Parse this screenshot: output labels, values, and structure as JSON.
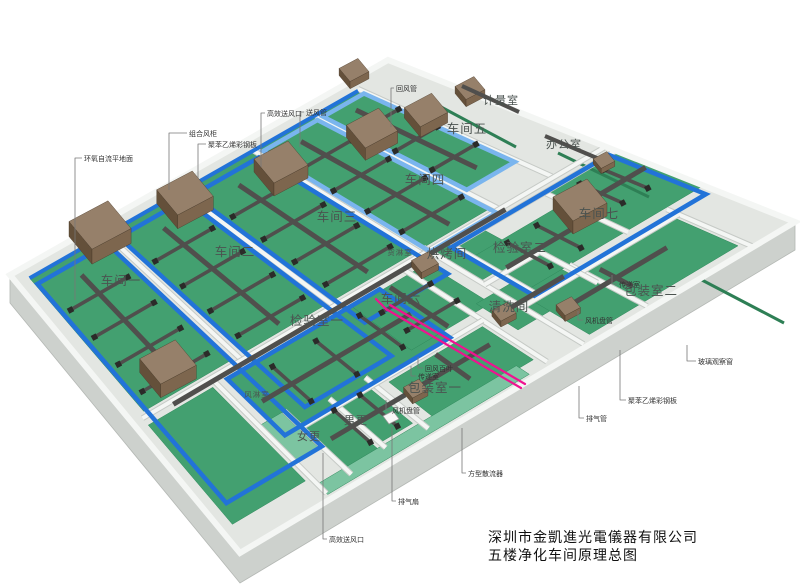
{
  "title": {
    "company": "深圳市金凱進光電儀器有限公司",
    "drawing": "五楼净化车间原理总图"
  },
  "room_labels": [
    {
      "id": "workshop-1",
      "label": "车间一",
      "x": 121,
      "y": 285,
      "fs": 12.5
    },
    {
      "id": "workshop-2",
      "label": "车间二",
      "x": 235,
      "y": 256,
      "fs": 12.5
    },
    {
      "id": "workshop-3",
      "label": "车间三",
      "x": 337,
      "y": 221,
      "fs": 12.5
    },
    {
      "id": "workshop-4",
      "label": "车间四",
      "x": 425,
      "y": 184,
      "fs": 12.5
    },
    {
      "id": "workshop-5",
      "label": "车间五",
      "x": 467,
      "y": 133,
      "fs": 12.5
    },
    {
      "id": "workshop-6",
      "label": "车间六",
      "x": 401,
      "y": 303,
      "fs": 12.5
    },
    {
      "id": "workshop-7",
      "label": "车间七",
      "x": 599,
      "y": 218,
      "fs": 12.5
    },
    {
      "id": "inspection-1",
      "label": "检验室一",
      "x": 317,
      "y": 325,
      "fs": 12.5
    },
    {
      "id": "inspection-2",
      "label": "检验室二",
      "x": 520,
      "y": 252,
      "fs": 12.5
    },
    {
      "id": "cleaning-room",
      "label": "清洗间",
      "x": 509,
      "y": 311,
      "fs": 12.5
    },
    {
      "id": "baking-room",
      "label": "烘烤间",
      "x": 447,
      "y": 258,
      "fs": 12.5
    },
    {
      "id": "packing-1",
      "label": "包装室一",
      "x": 435,
      "y": 392,
      "fs": 12.5
    },
    {
      "id": "packing-2",
      "label": "包装室二",
      "x": 651,
      "y": 295,
      "fs": 12.5
    },
    {
      "id": "men-changing",
      "label": "男更",
      "x": 356,
      "y": 424,
      "fs": 11
    },
    {
      "id": "women-changing",
      "label": "女更",
      "x": 309,
      "y": 440,
      "fs": 11
    },
    {
      "id": "air-shower",
      "label": "风淋室",
      "x": 257,
      "y": 397,
      "fs": 7.5
    },
    {
      "id": "cargo-shower",
      "label": "货淋室",
      "x": 400,
      "y": 255,
      "fs": 7.5
    },
    {
      "id": "office",
      "label": "办公室",
      "x": 564,
      "y": 148,
      "fs": 11
    },
    {
      "id": "metrology-room",
      "label": "计量室",
      "x": 501,
      "y": 104,
      "fs": 11
    }
  ],
  "callouts": [
    {
      "id": "epoxy-floor",
      "label": "环氧自流平地面",
      "tx": 84,
      "ty": 161,
      "line": [
        [
          82,
          158
        ],
        [
          75,
          158
        ],
        [
          75,
          300
        ]
      ]
    },
    {
      "id": "combined-ahu",
      "label": "组合风柜",
      "tx": 189,
      "ty": 136,
      "line": [
        [
          187,
          133
        ],
        [
          169,
          133
        ],
        [
          169,
          190
        ]
      ]
    },
    {
      "id": "steel-panel-1",
      "label": "聚苯乙烯彩钢板",
      "tx": 208,
      "ty": 147,
      "line": [
        [
          206,
          144
        ],
        [
          198,
          144
        ],
        [
          198,
          178
        ]
      ]
    },
    {
      "id": "hepa-outlet-1",
      "label": "高效送风口",
      "tx": 267,
      "ty": 116,
      "line": [
        [
          265,
          113
        ],
        [
          261,
          113
        ],
        [
          261,
          167
        ]
      ]
    },
    {
      "id": "supply-duct",
      "label": "送风管",
      "tx": 306,
      "ty": 115,
      "line": [
        [
          304,
          112
        ],
        [
          300,
          112
        ],
        [
          300,
          147
        ]
      ]
    },
    {
      "id": "return-duct",
      "label": "回风管",
      "tx": 396,
      "ty": 91,
      "line": [
        [
          394,
          88
        ],
        [
          391,
          88
        ],
        [
          391,
          127
        ]
      ]
    },
    {
      "id": "glass-window",
      "label": "玻璃观察窗",
      "tx": 698,
      "ty": 364,
      "line": [
        [
          696,
          361
        ],
        [
          687,
          361
        ],
        [
          687,
          345
        ]
      ]
    },
    {
      "id": "steel-panel-2",
      "label": "聚苯乙烯彩钢板",
      "tx": 628,
      "ty": 403,
      "line": [
        [
          626,
          400
        ],
        [
          620,
          400
        ],
        [
          620,
          350
        ]
      ]
    },
    {
      "id": "exhaust-pipe",
      "label": "排气管",
      "tx": 586,
      "ty": 421,
      "line": [
        [
          584,
          418
        ],
        [
          579,
          418
        ],
        [
          579,
          386
        ]
      ]
    },
    {
      "id": "square-diffuser",
      "label": "方型散流器",
      "tx": 468,
      "ty": 476,
      "line": [
        [
          466,
          473
        ],
        [
          462,
          473
        ],
        [
          462,
          428
        ]
      ]
    },
    {
      "id": "exhaust-fan",
      "label": "排气扇",
      "tx": 398,
      "ty": 504,
      "line": [
        [
          396,
          501
        ],
        [
          392,
          501
        ],
        [
          392,
          427
        ]
      ]
    },
    {
      "id": "hepa-outlet-2",
      "label": "高效送风口",
      "tx": 329,
      "ty": 542,
      "line": [
        [
          327,
          539
        ],
        [
          323,
          539
        ],
        [
          323,
          453
        ]
      ]
    },
    {
      "id": "fan-coil-1",
      "label": "风机盘管",
      "tx": 392,
      "ty": 413,
      "line": [
        [
          390,
          410
        ],
        [
          386,
          410
        ],
        [
          386,
          400
        ]
      ]
    },
    {
      "id": "fan-coil-2",
      "label": "风机盘管",
      "tx": 585,
      "ty": 323,
      "line": [
        [
          583,
          320
        ],
        [
          578,
          320
        ],
        [
          578,
          311
        ]
      ]
    },
    {
      "id": "return-louver",
      "label": "回风百叶",
      "tx": 425,
      "ty": 371,
      "line": [
        [
          423,
          368
        ],
        [
          418,
          368
        ],
        [
          418,
          357
        ]
      ]
    },
    {
      "id": "transfer-room-1",
      "label": "传递室",
      "tx": 418,
      "ty": 379,
      "line": [
        [
          416,
          376
        ],
        [
          411,
          376
        ],
        [
          411,
          366
        ]
      ]
    },
    {
      "id": "transfer-room-2",
      "label": "传递室",
      "tx": 619,
      "ty": 287,
      "line": [
        [
          617,
          284
        ],
        [
          612,
          284
        ],
        [
          612,
          275
        ]
      ]
    }
  ],
  "colors": {
    "floor_green": "#43a070",
    "floor_green_light": "#7cc4a1",
    "supply_blue": "#2273d8",
    "supply_blue_light": "#7ab5ee",
    "exhaust_dark": "#504f4d",
    "exhaust_cap": "#2b2b29",
    "ahu_brown_top": "#96806a",
    "ahu_brown_side": "#7d664e",
    "ahu_brown_front": "#64503a",
    "exhaust_pink": "#ee1390",
    "slab_top": "#e3e6e2",
    "slab_side": "#cdd1cd",
    "wall_white": "#f4f6f4",
    "wall_edge": "#c6cac6",
    "stripe_green": "#2e7f55",
    "label_color": "#4b5350",
    "callout_color": "#333333"
  }
}
